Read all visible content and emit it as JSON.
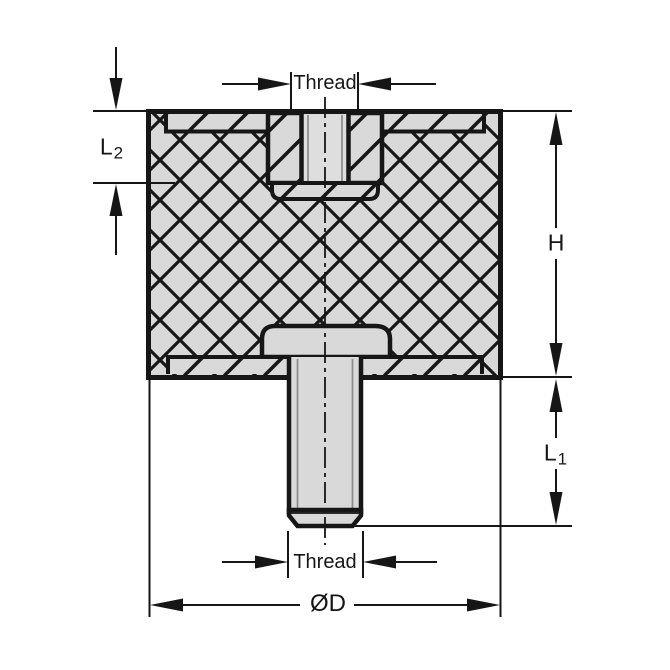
{
  "drawing": {
    "title": "vibration-mount-section-drawing",
    "labels": {
      "thread_top": "Thread",
      "thread_bottom": "Thread",
      "height": "H",
      "l1_letter": "L",
      "l1_sub": "1",
      "l2_letter": "L",
      "l2_sub": "2",
      "diameter": "ØD"
    },
    "colors": {
      "line": "#161616",
      "metal_fill": "#d9d9d9",
      "hole_fill": "#dedede",
      "thread_line": "#8a8a8a",
      "background": "#ffffff"
    }
  }
}
